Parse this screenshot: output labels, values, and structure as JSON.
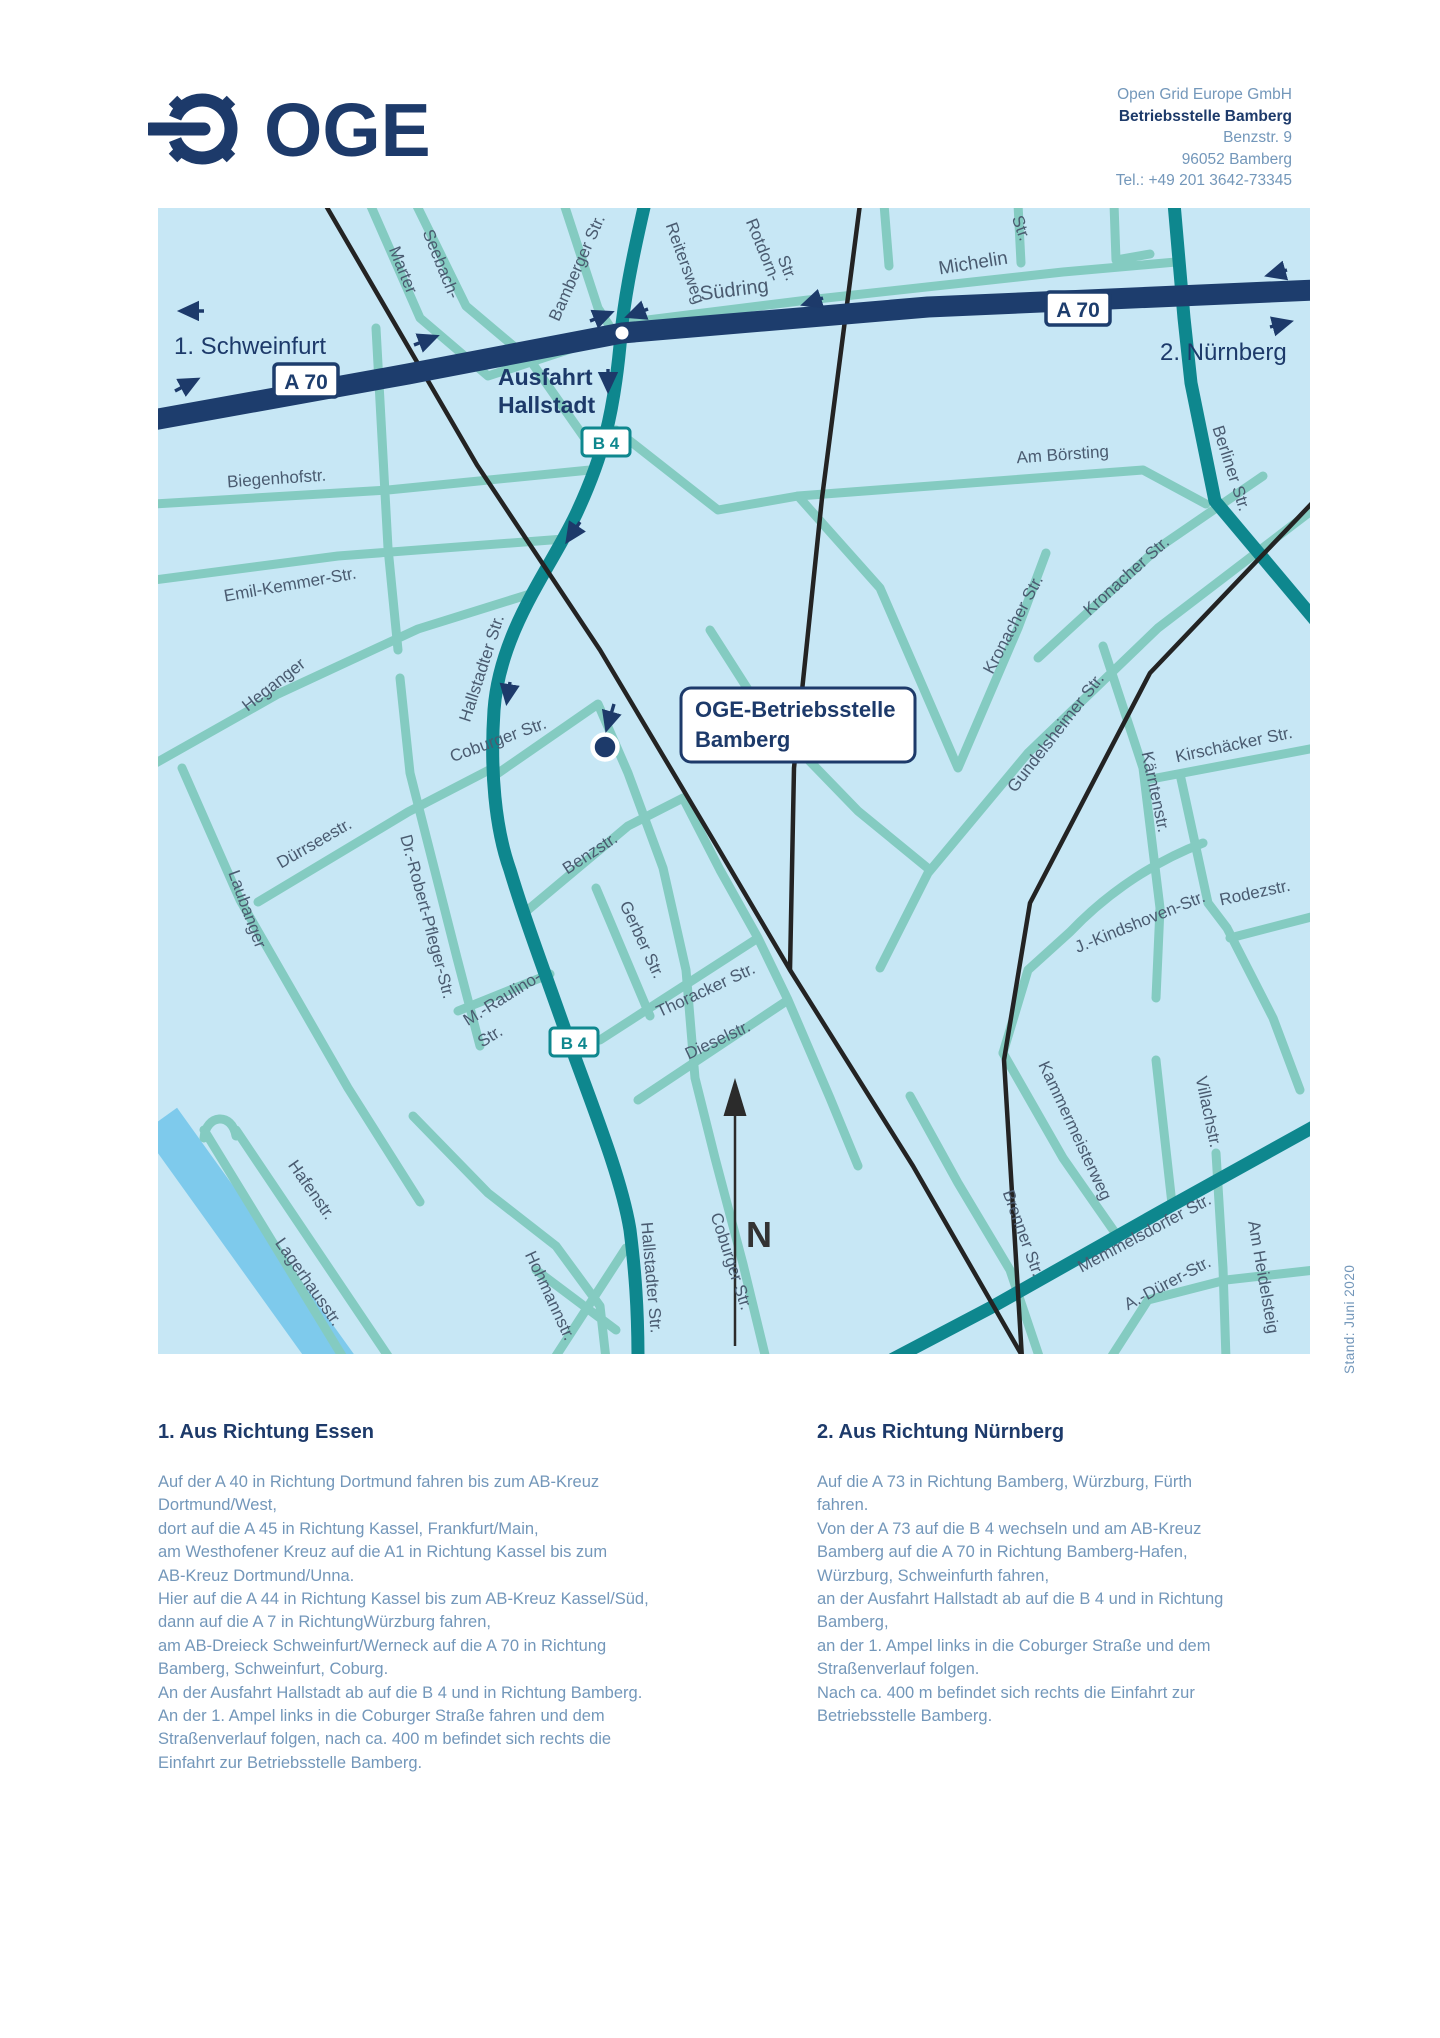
{
  "header": {
    "logo_text": "OGE",
    "address": {
      "line1": "Open Grid Europe GmbH",
      "line2": "Betriebsstelle Bamberg",
      "line3": "Benzstr. 9",
      "line4": "96052 Bamberg",
      "line5": "Tel.: +49 201 3642-73345"
    }
  },
  "map": {
    "badge_a70": "A 70",
    "badge_b4": "B 4",
    "poi_box": {
      "line1": "OGE-Betriebsstelle",
      "line2": "Bamberg"
    },
    "north_label": "N",
    "colors": {
      "navy": "#1d3a6a",
      "teal": "#0e878e",
      "street": "#84cbc1",
      "background": "#c7e7f5",
      "river": "#7ecaec",
      "railway": "#232323",
      "label": "#4a5b70",
      "body_text": "#7397ba",
      "white": "#ffffff"
    },
    "nav_texts": [
      {
        "name": "direction-schweinfurt",
        "text": "1. Schweinfurt",
        "x": 16,
        "y": 146,
        "rot": 0,
        "size": 24,
        "bold": false
      },
      {
        "name": "direction-nuernberg",
        "text": "2. Nürnberg",
        "x": 1002,
        "y": 152,
        "rot": 0,
        "size": 24,
        "bold": false
      },
      {
        "name": "exit-label-line1",
        "text": "Ausfahrt",
        "x": 340,
        "y": 177,
        "rot": 0,
        "size": 23,
        "bold": true
      },
      {
        "name": "exit-label-line2",
        "text": "Hallstadt",
        "x": 340,
        "y": 205,
        "rot": 0,
        "size": 23,
        "bold": true
      }
    ],
    "street_labels": [
      {
        "text": "Marter",
        "x": 240,
        "y": 64,
        "rot": 68
      },
      {
        "text": "Seebach-",
        "x": 278,
        "y": 58,
        "rot": 68
      },
      {
        "text": "Bamberger Str.",
        "x": 424,
        "y": 62,
        "rot": -66
      },
      {
        "text": "Reitersweg",
        "x": 522,
        "y": 57,
        "rot": 70
      },
      {
        "text": "Südring",
        "x": 577,
        "y": 88,
        "rot": -7,
        "size": 20
      },
      {
        "text": "Rotdorn-",
        "x": 600,
        "y": 44,
        "rot": 68
      },
      {
        "text": "Str.",
        "x": 624,
        "y": 62,
        "rot": 68
      },
      {
        "text": "Michelin",
        "x": 816,
        "y": 61,
        "rot": -9,
        "size": 19
      },
      {
        "text": "Str.",
        "x": 858,
        "y": 22,
        "rot": 70
      },
      {
        "text": "Berliner Str.",
        "x": 1068,
        "y": 262,
        "rot": 72
      },
      {
        "text": "Am Börsting",
        "x": 905,
        "y": 252,
        "rot": -4
      },
      {
        "text": "Biegenhofstr.",
        "x": 119,
        "y": 276,
        "rot": -4
      },
      {
        "text": "Emil-Kemmer-Str.",
        "x": 133,
        "y": 382,
        "rot": -10
      },
      {
        "text": "Heganger",
        "x": 119,
        "y": 481,
        "rot": -38
      },
      {
        "text": "Hallstadter Str.",
        "x": 329,
        "y": 462,
        "rot": -72
      },
      {
        "text": "Coburger Str.",
        "x": 342,
        "y": 537,
        "rot": -20
      },
      {
        "text": "Kronacher Str.",
        "x": 972,
        "y": 372,
        "rot": -42
      },
      {
        "text": "Kronacher Str.",
        "x": 860,
        "y": 419,
        "rot": -62
      },
      {
        "text": "Gundelsheimer Str.",
        "x": 902,
        "y": 528,
        "rot": -52
      },
      {
        "text": "Kärntenstr.",
        "x": 992,
        "y": 585,
        "rot": 78
      },
      {
        "text": "Kirschäcker Str.",
        "x": 1077,
        "y": 542,
        "rot": -12
      },
      {
        "text": "J.-Kindshoven-Str.",
        "x": 984,
        "y": 719,
        "rot": -22
      },
      {
        "text": "Rodezstr.",
        "x": 1098,
        "y": 690,
        "rot": -12
      },
      {
        "text": "Dürrseestr.",
        "x": 159,
        "y": 640,
        "rot": -30
      },
      {
        "text": "Laubanger",
        "x": 84,
        "y": 703,
        "rot": 70
      },
      {
        "text": "Dr.-Robert-Pfleger-Str.",
        "x": 264,
        "y": 710,
        "rot": 75
      },
      {
        "text": "M.-Raulino-",
        "x": 347,
        "y": 795,
        "rot": -32
      },
      {
        "text": "Str.",
        "x": 335,
        "y": 833,
        "rot": -32
      },
      {
        "text": "Benzstr.",
        "x": 435,
        "y": 650,
        "rot": -33
      },
      {
        "text": "Gerber Str.",
        "x": 479,
        "y": 734,
        "rot": 65
      },
      {
        "text": "Thoracker Str.",
        "x": 550,
        "y": 787,
        "rot": -25
      },
      {
        "text": "Dieselstr.",
        "x": 562,
        "y": 837,
        "rot": -25
      },
      {
        "text": "Hallstadter Str.",
        "x": 488,
        "y": 1070,
        "rot": 85
      },
      {
        "text": "Coburger Str.",
        "x": 568,
        "y": 1055,
        "rot": 72
      },
      {
        "text": "Hohmannstr.",
        "x": 387,
        "y": 1090,
        "rot": 65
      },
      {
        "text": "Hafenstr.",
        "x": 149,
        "y": 985,
        "rot": 55
      },
      {
        "text": "Lagerhausstr.",
        "x": 146,
        "y": 1077,
        "rot": 55
      },
      {
        "text": "Memmelsdorfer Str.",
        "x": 989,
        "y": 1030,
        "rot": -28
      },
      {
        "text": "A.-Dürer-Str.",
        "x": 1012,
        "y": 1080,
        "rot": -28
      },
      {
        "text": "Am Heidelsteig",
        "x": 1100,
        "y": 1070,
        "rot": 80
      },
      {
        "text": "Brenner Str.",
        "x": 860,
        "y": 1027,
        "rot": 70
      },
      {
        "text": "Kammermeisterweg",
        "x": 912,
        "y": 925,
        "rot": 65
      },
      {
        "text": "Villachstr.",
        "x": 1045,
        "y": 905,
        "rot": 78
      }
    ],
    "arrows": [
      {
        "x1": 46,
        "y1": 103,
        "x2": 24,
        "y2": 103
      },
      {
        "x1": 17,
        "y1": 183,
        "x2": 38,
        "y2": 172
      },
      {
        "x1": 256,
        "y1": 137,
        "x2": 277,
        "y2": 129
      },
      {
        "x1": 432,
        "y1": 113,
        "x2": 452,
        "y2": 105
      },
      {
        "x1": 490,
        "y1": 101,
        "x2": 471,
        "y2": 108
      },
      {
        "x1": 665,
        "y1": 90,
        "x2": 647,
        "y2": 96
      },
      {
        "x1": 1129,
        "y1": 62,
        "x2": 1111,
        "y2": 67
      },
      {
        "x1": 1112,
        "y1": 119,
        "x2": 1131,
        "y2": 114
      },
      {
        "x1": 450,
        "y1": 161,
        "x2": 450,
        "y2": 181
      },
      {
        "x1": 422,
        "y1": 314,
        "x2": 410,
        "y2": 332
      },
      {
        "x1": 352,
        "y1": 474,
        "x2": 349,
        "y2": 493
      },
      {
        "x1": 456,
        "y1": 496,
        "x2": 449,
        "y2": 520
      }
    ]
  },
  "footer": {
    "stand": "Stand: Juni 2020"
  },
  "directions": {
    "col1": {
      "title": "1. Aus Richtung Essen",
      "body": "Auf der A 40 in Richtung Dortmund fahren bis zum AB-Kreuz\nDortmund/West,\ndort auf die A 45 in Richtung Kassel, Frankfurt/Main,\nam Westhofener Kreuz auf die A1 in Richtung Kassel bis zum\nAB-Kreuz Dortmund/Unna.\nHier auf die A 44 in Richtung Kassel bis zum AB-Kreuz Kassel/Süd,\ndann auf die A 7 in RichtungWürzburg fahren,\nam AB-Dreieck Schweinfurt/Werneck auf die A 70 in Richtung\nBamberg, Schweinfurt, Coburg.\nAn der Ausfahrt Hallstadt ab auf die B 4 und in Richtung Bamberg.\nAn der 1. Ampel links in die Coburger Straße fahren und dem\nStraßenverlauf folgen, nach ca. 400 m befindet sich rechts die\nEinfahrt zur Betriebsstelle Bamberg."
    },
    "col2": {
      "title": "2. Aus Richtung Nürnberg",
      "body": "Auf die A 73 in Richtung Bamberg, Würzburg, Fürth\nfahren.\nVon der A 73 auf die B 4 wechseln und am AB-Kreuz\nBamberg auf die A 70 in Richtung Bamberg-Hafen,\nWürzburg, Schweinfurth fahren,\nan der Ausfahrt Hallstadt ab auf die B 4 und in Richtung\nBamberg,\nan der 1. Ampel links in die Coburger Straße und dem\nStraßenverlauf folgen.\nNach ca. 400 m befindet sich rechts die Einfahrt zur\nBetriebsstelle Bamberg."
    }
  }
}
